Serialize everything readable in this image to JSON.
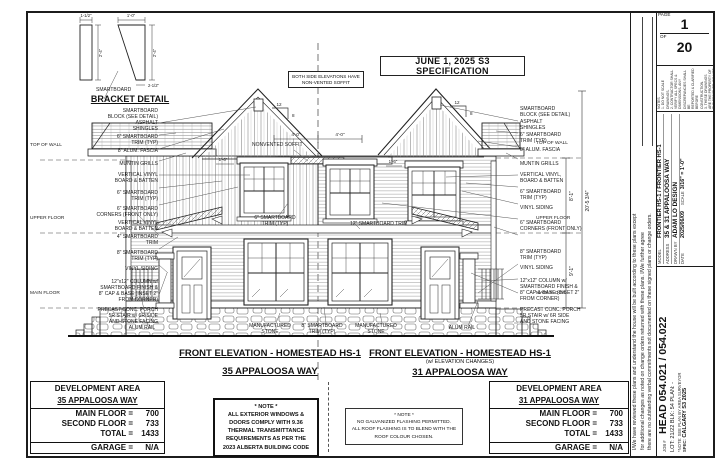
{
  "banner": {
    "spec": "JUNE 1, 2025 S3 SPECIFICATION",
    "soffit_note": "BOTH SIDE ELEVATIONS HAVE\nNON-VENTED SOFFIT"
  },
  "bracket_detail": {
    "title": "BRACKET DETAIL",
    "part_label": "SMARTBOARD",
    "dim_w1": "1-1/2\"",
    "dim_w2": "1'-0\"",
    "dim_h1": "2'-4\"",
    "dim_h2": "2'-4\"",
    "dim_b2": "2-1/2\""
  },
  "elevations": {
    "left": {
      "title": "FRONT ELEVATION - HOMESTEAD HS-1",
      "address": "35 APPALOOSA WAY"
    },
    "right": {
      "title": "FRONT ELEVATION - HOMESTEAD HS-1",
      "subtitle": "(w/ ELEVATION CHANGES)",
      "address": "31 APPALOOSA WAY"
    }
  },
  "levels": {
    "top_of_wall": "TOP OF WALL",
    "upper_floor": "UPPER FLOOR",
    "main_floor": "MAIN FLOOR"
  },
  "dims": {
    "soffit_left": "4'-0\"",
    "soffit_right": "4'-0\"",
    "win_left": "1'-6\"",
    "win_right": "1'-6\"",
    "upper_height": "8'-1\"",
    "main_height": "9'-1\"",
    "total_height": "20'-5 3/4\"",
    "pitch_run": "12",
    "pitch_rise": "8"
  },
  "labels": {
    "left": [
      {
        "text": "SMARTBOARD\nBLOCK (SEE DETAIL)"
      },
      {
        "text": "ASPHALT\nSHINGLES"
      },
      {
        "text": "6\" SMARTBOARD\nTRIM (TYP)"
      },
      {
        "text": "8\" ALUM. FASCIA"
      },
      {
        "text": "MUNTIN GRILLS"
      },
      {
        "text": "VERTICAL VINYL\nBOARD & BATTEN"
      },
      {
        "text": "6\" SMARTBOARD\nTRIM (TYP)"
      },
      {
        "text": "6\" SMARTBOARD\nCORNERS (FRONT ONLY)"
      },
      {
        "text": "VERTICAL VINYL\nBOARD & BATTEN"
      },
      {
        "text": "4\" SMARTBOARD\nTRIM"
      },
      {
        "text": "8\" SMARTBOARD\nTRIM (TYP)"
      },
      {
        "text": "VINYL SIDING"
      },
      {
        "text": "12\"x12\" COLUMN w/\nSMARTBOARD FINISH &\n8\" CAP & BASE (INSET 2\"\nFROM CORNER)"
      },
      {
        "text": "PRECAST CONC. PORCH\n5R STAIR w/ 6R SIDE\nAND STONE FACING"
      }
    ],
    "right": [
      {
        "text": "SMARTBOARD\nBLOCK (SEE DETAIL)"
      },
      {
        "text": "ASPHALT\nSHINGLES"
      },
      {
        "text": "6\" SMARTBOARD\nTRIM (TYP)"
      },
      {
        "text": "8\" ALUM. FASCIA"
      },
      {
        "text": "MUNTIN GRILLS"
      },
      {
        "text": "VERTICAL VINYL,\nBOARD & BATTEN"
      },
      {
        "text": "6\" SMARTBOARD\nTRIM (TYP)"
      },
      {
        "text": "VINYL SIDING"
      },
      {
        "text": "6\" SMARTBOARD\nCORNERS (FRONT ONLY)"
      },
      {
        "text": "8\" SMARTBOARD\nTRIM (TYP)"
      },
      {
        "text": "VINYL SIDING"
      },
      {
        "text": "12\"x12\" COLUMN w/\nSMARTBOARD FINISH &\n8\" CAP & BASE (INSET 2\"\nFROM CORNER)"
      },
      {
        "text": "PRECAST CONC. PORCH\n5R STAIR w/ 6R SIDE\nAND STONE FACING"
      }
    ],
    "center": {
      "soffit": "NONVENTED SOFFIT",
      "trim6": "6\" SMARTBOARD\nTRIM (TYP)",
      "trim12": "12\" SMARTBOARD TRIM"
    },
    "bottom": [
      {
        "text": "ALUM RAIL"
      },
      {
        "text": "MANUFACTURED\nSTONE"
      },
      {
        "text": "8\" SMARTBOARD\nTRIM (TYP)"
      },
      {
        "text": "MANUFACTURED\nSTONE"
      },
      {
        "text": "ALUM RAIL"
      }
    ]
  },
  "dev_tables": {
    "left": {
      "title": "DEVELOPMENT AREA",
      "address": "35 APPALOOSA WAY",
      "rows": [
        {
          "label": "MAIN FLOOR =",
          "value": "700"
        },
        {
          "label": "SECOND FLOOR =",
          "value": "733"
        },
        {
          "label": "TOTAL =",
          "value": "1433"
        }
      ],
      "garage_label": "GARAGE =",
      "garage_value": "N/A"
    },
    "right": {
      "title": "DEVELOPMENT AREA",
      "address": "31 APPALOOSA WAY",
      "rows": [
        {
          "label": "MAIN FLOOR =",
          "value": "700"
        },
        {
          "label": "SECOND FLOOR =",
          "value": "733"
        },
        {
          "label": "TOTAL =",
          "value": "1433"
        }
      ],
      "garage_label": "GARAGE =",
      "garage_value": "N/A"
    }
  },
  "notes": {
    "windows": "* NOTE *\nALL EXTERIOR WINDOWS &\nDOORS COMPLY WITH 9.36\nTHERMAL TRANSMITTANCE\nREQUIREMENTS AS PER THE\n2023 ALBERTA BUILDING CODE",
    "flashing": "* NOTE *\nNO GALVANIZED FLASHING PERMITTED.\nALL ROOF FLASHING IS TO BLEND WITH THE\nROOF COLOUR CHOSEN."
  },
  "titleblock": {
    "page_label": "PAGE",
    "page_number": "1",
    "of_label": "OF",
    "page_total": "20",
    "notes_small": "NOTES\n1. DO NOT SCALE DRAWINGS.\n2. CONTRACTOR SHALL VERIFY ALL SPECS &\nDIMENSIONS. ANY DISCREPANCIES SHALL BE\nREPORTED & CLARIFIED BEFORE CONSTRUCTION.\n3. THESE DRAWINGS ARE THE PROPERTY OF\nTHE DESIGNER. DO NOT USE OR REPRODUCE\nWITHOUT CONSENT.",
    "model_label": "MODEL",
    "model": "FRONTIER HS-1 / FRONTIER HS-1",
    "address_label": "ADDRESS",
    "address": "35 & 31 APPALOOSA WAY",
    "drawn_label": "DRAWN BY",
    "drawn_by": "ADAM LO DESIGN",
    "date_label": "DATE",
    "date_fmt": "YYYY/MM/DD",
    "date": "2025/06/09",
    "scale_label": "SCALE",
    "scale": "3/16\" = 1'-0\"",
    "job_label": "JOB #",
    "job": "HEAD 054.021 / 054.022",
    "lot_line": "LOT: 21/22    BLK: 54    PLAN: -",
    "survey_note": "*NOTE: SEE PLAN BY AREA SURVEYOR",
    "spec_label": "SPEC:",
    "spec": "CALGARY S3 2025",
    "disclaimer": "I/We have reviewed these plans and understand the house will be built according to these plans except\nfor additional changes as noted on change orders returned with these plans.  I/We further agree\nthere are no outstanding verbal commitments not documented on these signed plans or change orders."
  }
}
